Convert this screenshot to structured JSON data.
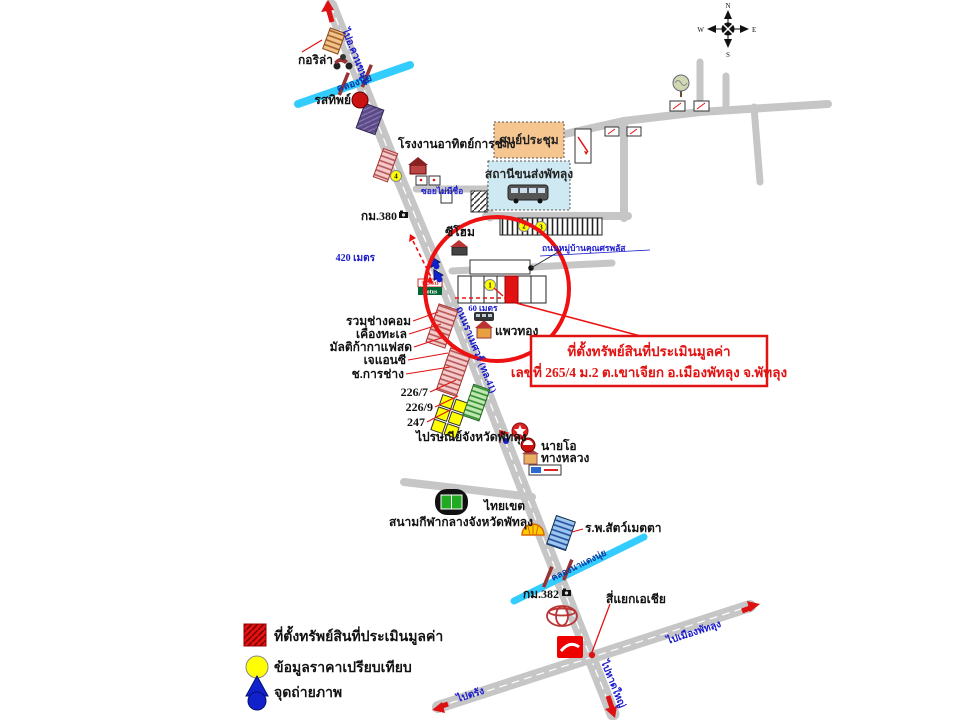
{
  "colors": {
    "road": "#c6c6c6",
    "canal": "#33ccff",
    "highlight_red": "#ee1111",
    "comparable_yellow": "#ffff00",
    "photo_blue": "#1122cc",
    "convention_orange": "#f6c690",
    "terminal_blue": "#cfe9f3"
  },
  "compass": {
    "n": "N",
    "e": "E",
    "s": "S",
    "w": "W"
  },
  "roads": {
    "main_name": "ถนนราเมศวร์ (ทล.41)",
    "to_north": "ไปอ.ควนขนุน",
    "to_south": "ไปหาดใหญ่",
    "to_east": "ไปเมืองพัทลุง",
    "to_west": "ไปตรัง",
    "soi": "ซอยไม่มีชื่อ",
    "village_road": "ถนนหมู่บ้านคุณศรพลัส",
    "junction": "สี่แยกเอเชีย"
  },
  "canals": {
    "north": "คลองนุ้ย",
    "south": "คลองนาแดงนุ่ย"
  },
  "distances": {
    "d420": "420 เมตร",
    "d60": "60 เมตร"
  },
  "km_posts": {
    "km380": "กม.380",
    "km382": "กม.382"
  },
  "places": {
    "gorilla": "กอริล่า",
    "rotsathip": "รสทิพย์",
    "factory": "โรงงานอาทิตย์การช่าง",
    "seehome": "ซีโฮม",
    "convention": "ศูนย์ประชุม",
    "bus_terminal": "สถานีขนส่งพัทลุง",
    "paewthong": "แพวทอง",
    "ruamchang_com": "รวมช่างคอม",
    "khueang_thale": "เคื่องทะเล",
    "multika": "มัลติก้ากาแฟสด",
    "j_and_c": "เจแอนซี",
    "cho_kanchang": "ช.การช่าง",
    "no_2267": "226/7",
    "no_2269": "226/9",
    "no_247": "247",
    "post_office": "ไปรษณีย์จังหวัดพัทลุง",
    "nai_o": "นายโอ",
    "thang_luang": "ทางหลวง",
    "thai_khet": "ไทยเขต",
    "stadium": "สนามกีฬากลางจังหวัดพัทลุง",
    "vet_hospital": "ร.พ.สัตว์เมตตา"
  },
  "comparables": {
    "c1": "1",
    "c2": "2",
    "c3": "3",
    "c4": "4"
  },
  "signs": {
    "lotus_top": "TESCO",
    "lotus_bottom": "Lotus"
  },
  "callout": {
    "line1": "ที่ตั้งทรัพย์สินที่ประเมินมูลค่า",
    "line2": "เลขที่ 265/4 ม.2 ต.เขาเจียก อ.เมืองพัทลุง จ.พัทลุง"
  },
  "legend": {
    "items": [
      {
        "label": "ที่ตั้งทรัพย์สินที่ประเมินมูลค่า"
      },
      {
        "label": "ข้อมูลราคาเปรียบเทียบ"
      },
      {
        "label": "จุดถ่ายภาพ"
      }
    ]
  }
}
